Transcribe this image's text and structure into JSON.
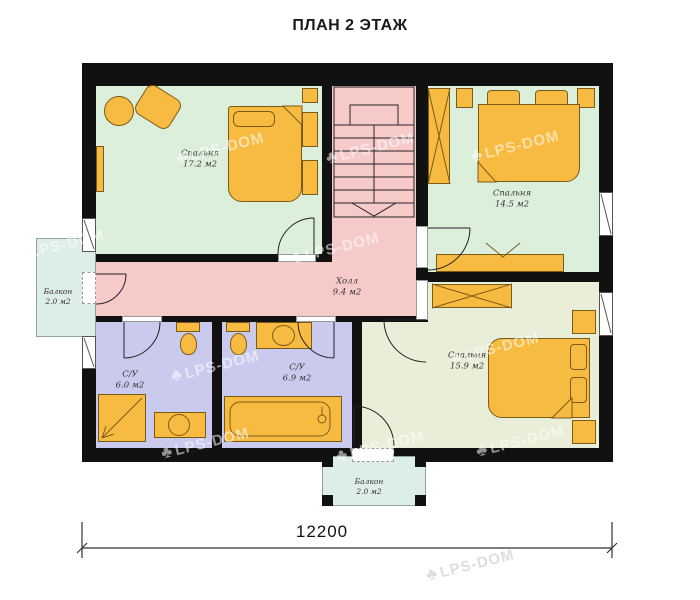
{
  "title": "ПЛАН 2 ЭТАЖ",
  "watermark": {
    "brand": "LPS-DOM",
    "icon": "tree-icon"
  },
  "dimension": {
    "width": "12200"
  },
  "rooms": {
    "bedroom1": {
      "name": "Спальня",
      "area": "17.2 м2"
    },
    "bedroom2": {
      "name": "Спальня",
      "area": "14.5 м2"
    },
    "hall": {
      "name": "Холл",
      "area": "9.4 м2"
    },
    "bathroom1": {
      "name": "С/У",
      "area": "6.0 м2"
    },
    "bathroom2": {
      "name": "С/У",
      "area": "6.9 м2"
    },
    "bedroom3": {
      "name": "Спальня",
      "area": "15.9 м2"
    },
    "balcony_left": {
      "name": "Балкон",
      "area": "2.0 м2"
    },
    "balcony_bottom": {
      "name": "Балкон",
      "area": "2.0 м2"
    }
  },
  "colors": {
    "wall": "#111111",
    "bedroom_fill": "#dcefdb",
    "bedroom3_fill": "#e8eed8",
    "hall_fill": "#f7caca",
    "bathroom_fill": "#cacaef",
    "balcony_fill": "#ddeee8",
    "furniture_fill": "#f7bb42"
  }
}
